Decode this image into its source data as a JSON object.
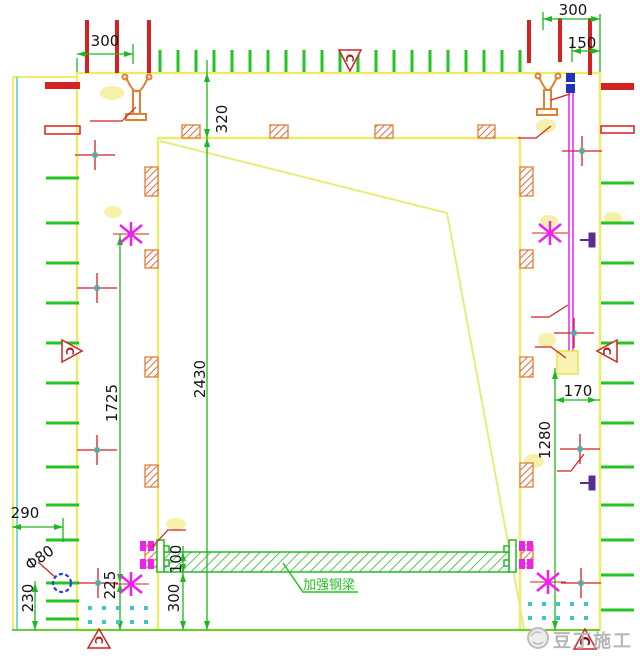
{
  "dims": {
    "w300_top_left": "300",
    "w300_top_right": "300",
    "w150_top_right": "150",
    "d320": "320",
    "h2430": "2430",
    "h1725": "1725",
    "h225": "225",
    "w290": "290",
    "h230": "230",
    "phi80": "Φ80",
    "h100": "100",
    "h300_bottom": "300",
    "h1280": "1280",
    "w170": "170"
  },
  "labels": {
    "beam": "加强钢梁",
    "section": "C"
  },
  "watermark": {
    "text": "豆丁施工"
  },
  "colors": {
    "wall_outline": "#ecec6a",
    "brace_yellow": "#e9ec7c",
    "dimension_green": "#1db81d",
    "tick_green": "#22c522",
    "mark_red": "#d42222",
    "hatch_orange": "#e08030",
    "tie_magenta": "#ee22ee",
    "aux_cyan": "#44c8c8",
    "hole_blue": "#2d3fd4",
    "clamp_orange": "#e08030",
    "watermark_gray": "#b6b6b6"
  }
}
